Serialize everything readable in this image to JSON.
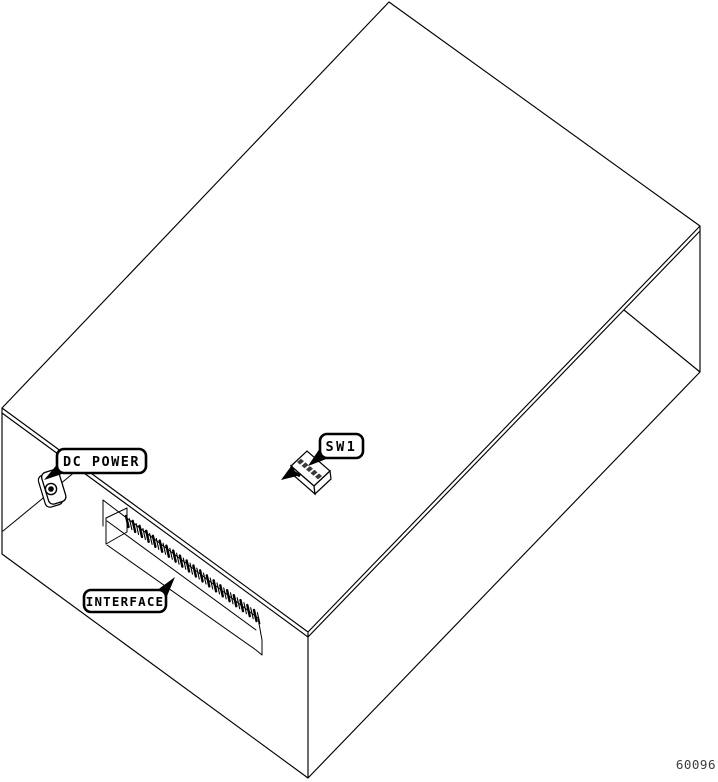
{
  "drawing": {
    "figure_number": "60096",
    "callouts": {
      "dc_power": {
        "label": "DC POWER"
      },
      "sw1": {
        "label": "SW1"
      },
      "interface": {
        "label": "INTERFACE"
      }
    },
    "colors": {
      "line": "#000000",
      "background": "#ffffff",
      "figure_number": "#3d3d3d"
    }
  }
}
